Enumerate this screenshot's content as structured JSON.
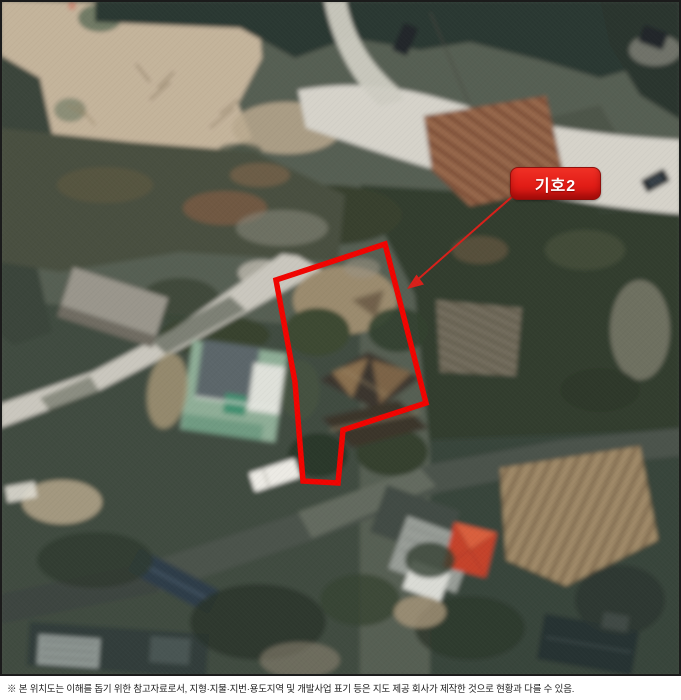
{
  "map": {
    "kind": "aerial-location-map",
    "annotation_label": "기호2",
    "colors": {
      "parcel_outline": "#f10400",
      "label_background": "#e21d17",
      "label_border": "#8f0f0b",
      "label_text": "#ffffff",
      "leader_line": "#d8201a"
    }
  },
  "footnote": {
    "text": "※ 본 위치도는 이해를 돕기 위한 참고자료로서, 지형·지물·지번·용도지역 및 개발사업 표기 등은 지도 제공 회사가 제작한 것으로 현황과 다를 수 있음."
  }
}
